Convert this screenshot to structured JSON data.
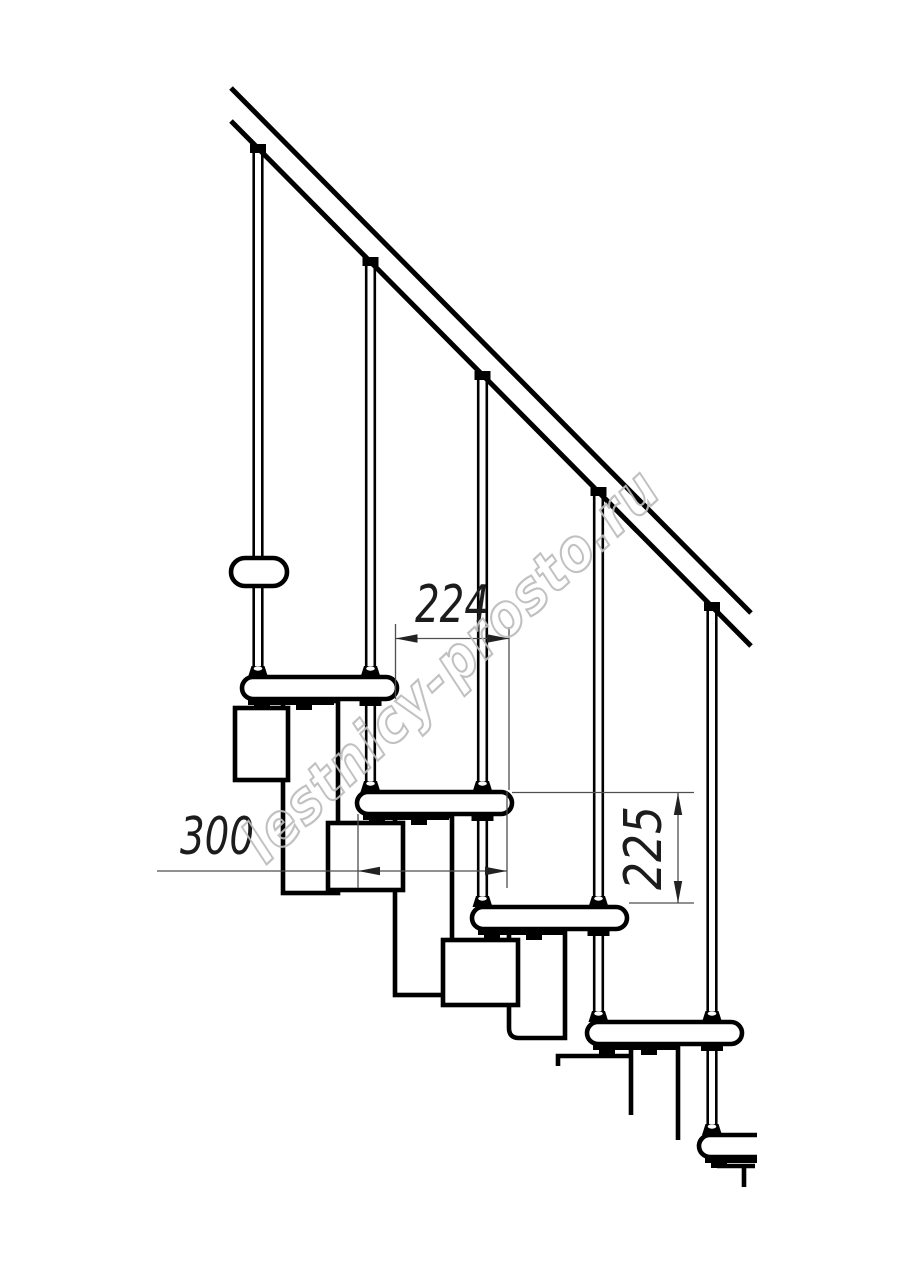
{
  "drawing": {
    "type": "staircase-side-elevation",
    "dimensions": {
      "step_run": {
        "value": "224"
      },
      "tread_depth": {
        "value": "300"
      },
      "step_rise": {
        "value": "225"
      }
    },
    "watermark": {
      "text": "lestnicy-prosto.ru"
    },
    "colors": {
      "line": "#000000",
      "thin": "#4f4f4f",
      "dim_text": "#1c1c1c",
      "watermark": "#bcbcbc",
      "background": "#ffffff"
    }
  }
}
